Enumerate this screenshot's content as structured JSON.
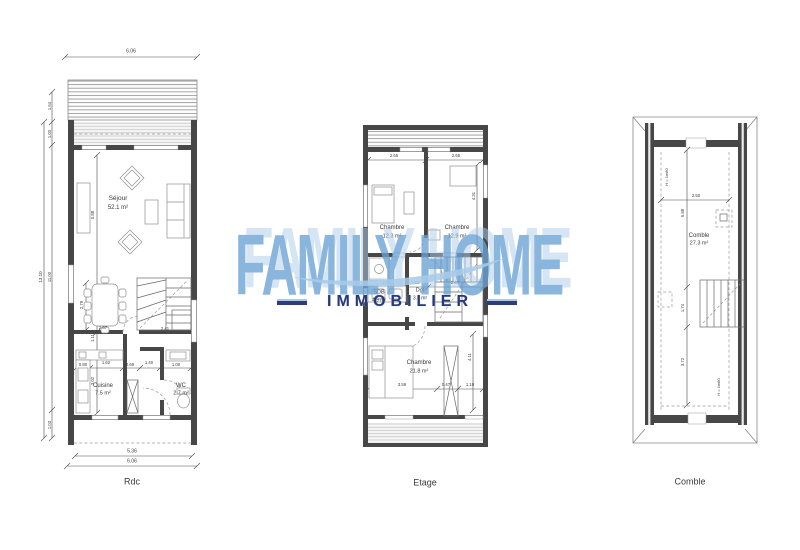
{
  "watermark": {
    "brand": "FAMILY HOME",
    "tagline": "IMMOBILIER",
    "brand_color": "#6aa2d4",
    "brand_shadow_color": "#add1e9",
    "tagline_color": "#2a3a78",
    "swoosh_color": "#a9cbe9"
  },
  "plan_titles": [
    "Rdc",
    "Etage",
    "Comble"
  ],
  "labels": [
    {
      "n": "dim-top-width",
      "t": "6.06",
      "x": 131,
      "y": 52,
      "s": 5
    },
    {
      "n": "dim-left-total",
      "t": "13.10",
      "x": 41,
      "y": 277,
      "r": -90,
      "s": 4.5
    },
    {
      "n": "dim-left-terrace",
      "t": "1.64",
      "x": 50,
      "y": 106,
      "r": -90,
      "s": 4.2
    },
    {
      "n": "dim-left-veranda",
      "t": "1.00",
      "x": 50,
      "y": 134,
      "r": -90,
      "s": 4.2
    },
    {
      "n": "dim-left-interior",
      "t": "11.00",
      "x": 50,
      "y": 277,
      "r": -90,
      "s": 4.2
    },
    {
      "n": "dim-left-porch",
      "t": "1.03",
      "x": 50,
      "y": 425,
      "r": -90,
      "s": 4.2
    },
    {
      "n": "room-sejour-name",
      "t": "Séjour",
      "x": 118,
      "y": 199,
      "s": 6.5
    },
    {
      "n": "room-sejour-area",
      "t": "52.1 m²",
      "x": 118,
      "y": 208,
      "s": 6
    },
    {
      "n": "dim-sejour-depth",
      "t": "5.88",
      "x": 93,
      "y": 215,
      "r": -90,
      "s": 4.2
    },
    {
      "n": "dim-dining-depth",
      "t": "2.79",
      "x": 82,
      "y": 305,
      "r": -90,
      "s": 4.2
    },
    {
      "n": "dim-hall-depth",
      "t": "1.11",
      "x": 93,
      "y": 338,
      "r": -90,
      "s": 4.2
    },
    {
      "n": "dim-cuisine-depth",
      "t": "3.02",
      "x": 93,
      "y": 381,
      "r": -90,
      "s": 4.2
    },
    {
      "n": "dim-stair-width-left",
      "t": "2.67",
      "x": 103,
      "y": 328,
      "s": 4.2
    },
    {
      "n": "dim-stair-width-right",
      "t": "2.41",
      "x": 165,
      "y": 329,
      "s": 4.2
    },
    {
      "n": "dim-cuisine-1",
      "t": "0.80",
      "x": 83,
      "y": 365,
      "s": 4.2
    },
    {
      "n": "dim-cuisine-2",
      "t": "1.62",
      "x": 106,
      "y": 363,
      "s": 4.2
    },
    {
      "n": "dim-cuisine-3",
      "t": "0.69",
      "x": 130,
      "y": 365,
      "s": 4.2
    },
    {
      "n": "dim-cuisine-4",
      "t": "1.40",
      "x": 149,
      "y": 363,
      "s": 4.2
    },
    {
      "n": "dim-cuisine-5",
      "t": "1.00",
      "x": 176,
      "y": 365,
      "s": 4.2
    },
    {
      "n": "room-cuisine-name",
      "t": "Cuisine",
      "x": 103,
      "y": 386,
      "s": 6
    },
    {
      "n": "room-cuisine-area",
      "t": "7.5 m²",
      "x": 103,
      "y": 394,
      "s": 5.5
    },
    {
      "n": "room-wc-name",
      "t": "WC",
      "x": 181,
      "y": 386,
      "s": 6
    },
    {
      "n": "room-wc-area",
      "t": "2.7 m²",
      "x": 181,
      "y": 394,
      "s": 5.5
    },
    {
      "n": "dim-bottom-inner",
      "t": "5.36",
      "x": 132,
      "y": 452,
      "s": 5
    },
    {
      "n": "dim-bottom-outer",
      "t": "6.06",
      "x": 132,
      "y": 462,
      "s": 5
    },
    {
      "n": "plan-title-rdc",
      "t": "Rdc",
      "x": 132,
      "y": 482,
      "s": 9
    },
    {
      "n": "dim-chambre1-width",
      "t": "2.65",
      "x": 394,
      "y": 156,
      "s": 4.2
    },
    {
      "n": "dim-chambre2-width",
      "t": "2.65",
      "x": 456,
      "y": 156,
      "s": 4.2
    },
    {
      "n": "dim-chambre2-depth",
      "t": "4.31",
      "x": 474,
      "y": 196,
      "r": -90,
      "s": 4.2
    },
    {
      "n": "room-chambre1-name",
      "t": "Chambre",
      "x": 392,
      "y": 228,
      "s": 6
    },
    {
      "n": "room-chambre1-area",
      "t": "12.3 m²",
      "x": 392,
      "y": 237,
      "s": 5.5
    },
    {
      "n": "room-chambre2-name",
      "t": "Chambre",
      "x": 457,
      "y": 228,
      "s": 6
    },
    {
      "n": "room-chambre2-area",
      "t": "12.9 m²",
      "x": 457,
      "y": 237,
      "s": 5.5
    },
    {
      "n": "dim-sdb-width",
      "t": "1.60",
      "x": 386,
      "y": 283,
      "s": 4.2
    },
    {
      "n": "dim-dgt-width",
      "t": "1.22",
      "x": 415,
      "y": 283,
      "s": 4.2
    },
    {
      "n": "dim-stairs-width",
      "t": "2.47",
      "x": 455,
      "y": 283,
      "s": 4.2
    },
    {
      "n": "room-sdb-name",
      "t": "SDB",
      "x": 379,
      "y": 293,
      "s": 5.5
    },
    {
      "n": "room-sdb-area",
      "t": "4.9 m²",
      "x": 379,
      "y": 301,
      "s": 5
    },
    {
      "n": "room-dgt-name",
      "t": "Dgt",
      "x": 420,
      "y": 291,
      "s": 5.5
    },
    {
      "n": "room-dgt-area",
      "t": "3.6 m²",
      "x": 420,
      "y": 299,
      "s": 5
    },
    {
      "n": "room-chambre3-name",
      "t": "Chambre",
      "x": 419,
      "y": 363,
      "s": 6
    },
    {
      "n": "room-chambre3-area",
      "t": "21.8 m²",
      "x": 419,
      "y": 372,
      "s": 5.5
    },
    {
      "n": "dim-chambre3-1",
      "t": "3.59",
      "x": 402,
      "y": 385,
      "s": 4.2
    },
    {
      "n": "dim-chambre3-2",
      "t": "0.47",
      "x": 446,
      "y": 385,
      "s": 4.2
    },
    {
      "n": "dim-chambre3-3",
      "t": "1.10",
      "x": 470,
      "y": 385,
      "s": 4.2
    },
    {
      "n": "dim-chambre3-depth",
      "t": "4.11",
      "x": 470,
      "y": 357,
      "r": -90,
      "s": 4.2
    },
    {
      "n": "plan-title-etage",
      "t": "Etage",
      "x": 425,
      "y": 483,
      "s": 9
    },
    {
      "n": "dim-comble-width",
      "t": "2.50",
      "x": 696,
      "y": 196,
      "s": 4.2
    },
    {
      "n": "dim-comble-upper",
      "t": "5.88",
      "x": 683,
      "y": 213,
      "r": -90,
      "s": 4.2
    },
    {
      "n": "height-limit-top",
      "t": "H = 1m80",
      "x": 667,
      "y": 177,
      "r": -90,
      "s": 4
    },
    {
      "n": "room-comble-name",
      "t": "Comble",
      "x": 699,
      "y": 236,
      "s": 6
    },
    {
      "n": "room-comble-area",
      "t": "27.3 m²",
      "x": 699,
      "y": 244,
      "s": 5.5
    },
    {
      "n": "dim-comble-mid",
      "t": "1.74",
      "x": 683,
      "y": 308,
      "r": -90,
      "s": 4.2
    },
    {
      "n": "dim-comble-lower",
      "t": "3.72",
      "x": 683,
      "y": 362,
      "r": -90,
      "s": 4.2
    },
    {
      "n": "height-limit-bottom",
      "t": "H = 1m80",
      "x": 719,
      "y": 387,
      "r": -90,
      "s": 4
    },
    {
      "n": "plan-title-comble",
      "t": "Comble",
      "x": 690,
      "y": 482,
      "s": 9
    }
  ]
}
